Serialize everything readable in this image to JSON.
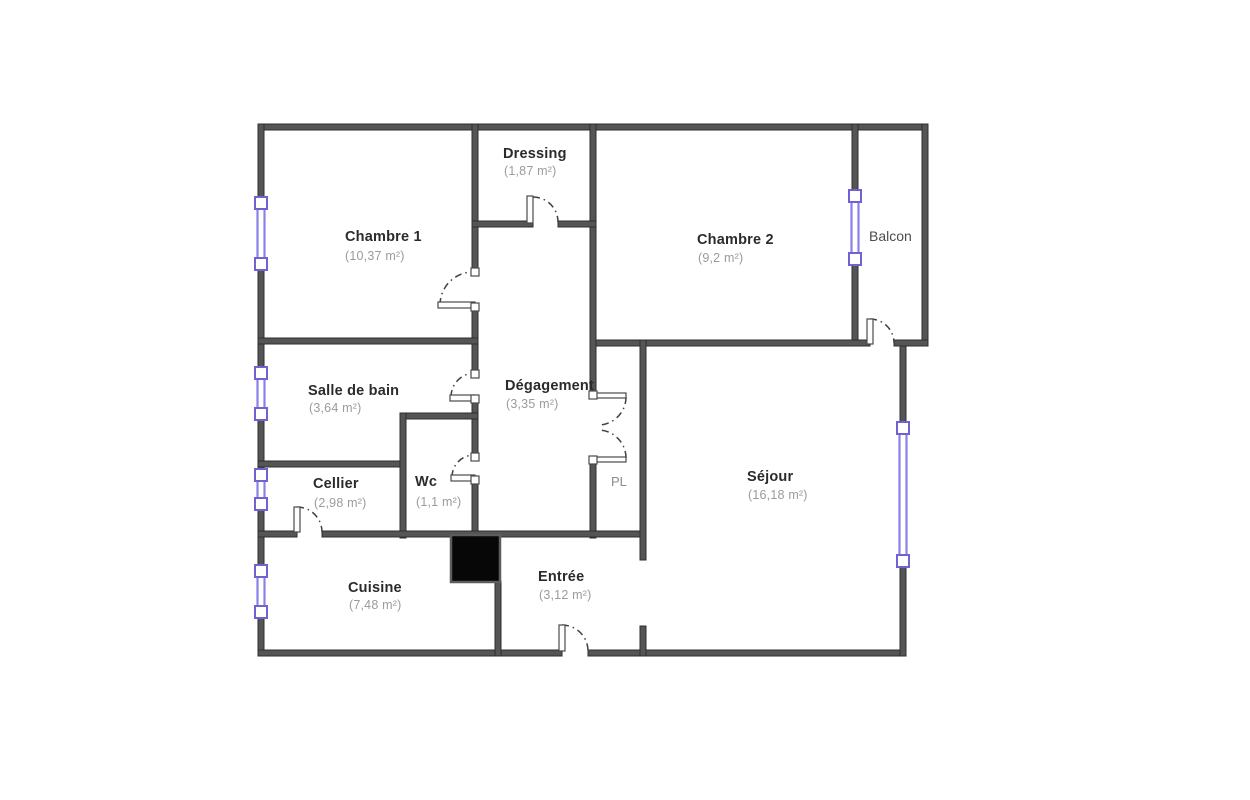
{
  "rooms": {
    "chambre1": {
      "name": "Chambre 1",
      "area": "(10,37 m²)"
    },
    "dressing": {
      "name": "Dressing",
      "area": "(1,87 m²)"
    },
    "chambre2": {
      "name": "Chambre 2",
      "area": "(9,2 m²)"
    },
    "balcon": {
      "name": "Balcon"
    },
    "salle_de_bain": {
      "name": "Salle de bain",
      "area": "(3,64 m²)"
    },
    "degagement": {
      "name": "Dégagement",
      "area": "(3,35 m²)"
    },
    "cellier": {
      "name": "Cellier",
      "area": "(2,98 m²)"
    },
    "wc": {
      "name": "Wc",
      "area": "(1,1 m²)"
    },
    "pl": {
      "name": "PL"
    },
    "sejour": {
      "name": "Séjour",
      "area": "(16,18 m²)"
    },
    "cuisine": {
      "name": "Cuisine",
      "area": "(7,48 m²)"
    },
    "entree": {
      "name": "Entrée",
      "area": "(3,12 m²)"
    }
  },
  "colors": {
    "wall": "#555555",
    "window": "#8a80e8",
    "window_frame": "#6f63d4",
    "room_name": "#2b2b2b",
    "room_area": "#9b9b9b",
    "door_arc": "#3f3f3f",
    "chimney": "#070707",
    "background": "#ffffff"
  }
}
